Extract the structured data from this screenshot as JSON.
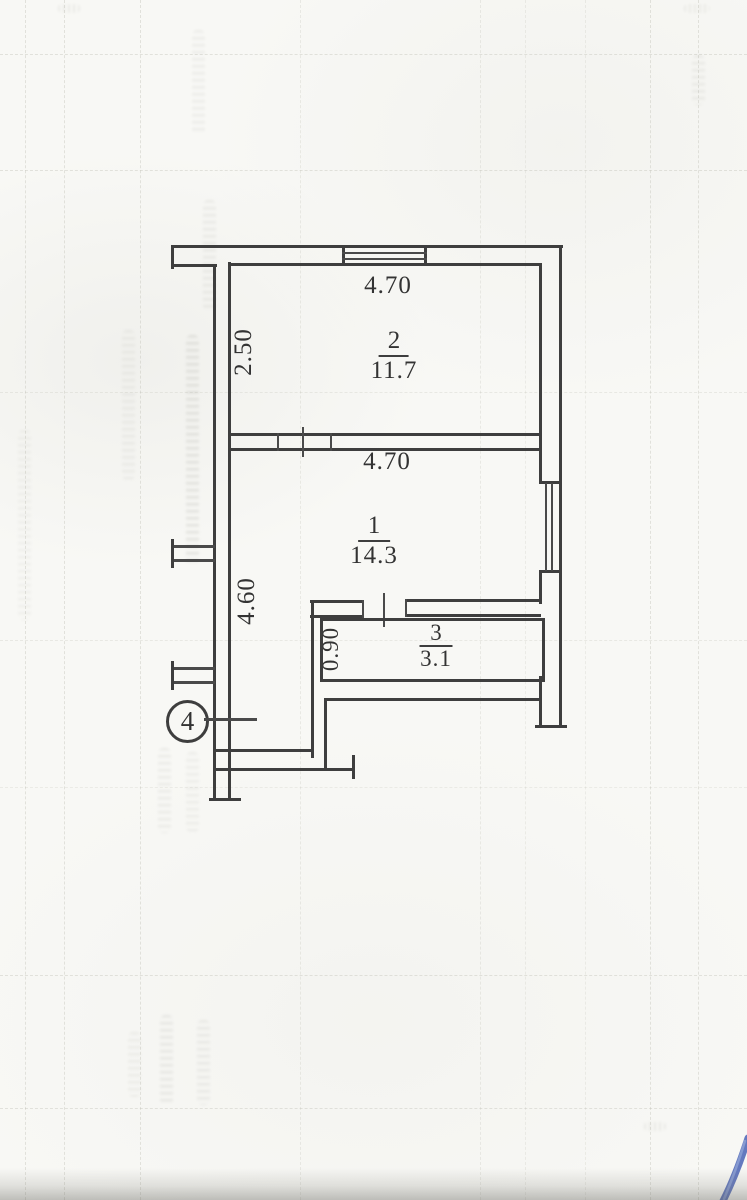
{
  "floor_plan": {
    "unit_label": "4",
    "rooms": [
      {
        "number": "2",
        "area": "11.7",
        "width_dim": "4.70",
        "height_dim": "2.50"
      },
      {
        "number": "1",
        "area": "14.3",
        "width_dim": "4.70",
        "height_dim": "4.60"
      },
      {
        "number": "3",
        "area": "3.1",
        "height_dim": "0.90"
      }
    ],
    "colors": {
      "wall_line": "#3e3e3e",
      "label_text": "#333333",
      "paper": "#f8f8f5",
      "pen_mark_blue": "#4a63b5"
    }
  }
}
